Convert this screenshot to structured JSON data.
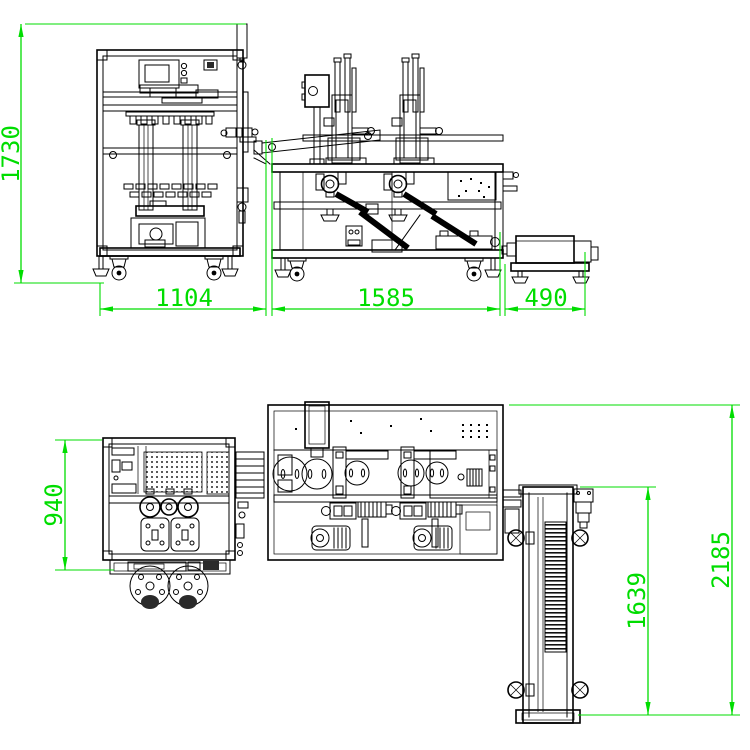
{
  "drawing": {
    "front_view": {
      "dim_height": "1730",
      "dim_width_left_machine": "1104",
      "dim_width_main_machine": "1585",
      "dim_width_outfeed": "490"
    },
    "plan_view": {
      "dim_depth": "940",
      "dim_conveyor": "1639",
      "dim_overall": "2185"
    },
    "colors": {
      "dimension_green": "#00DD00",
      "outline_black": "#000000",
      "background": "#FFFFFF"
    }
  }
}
